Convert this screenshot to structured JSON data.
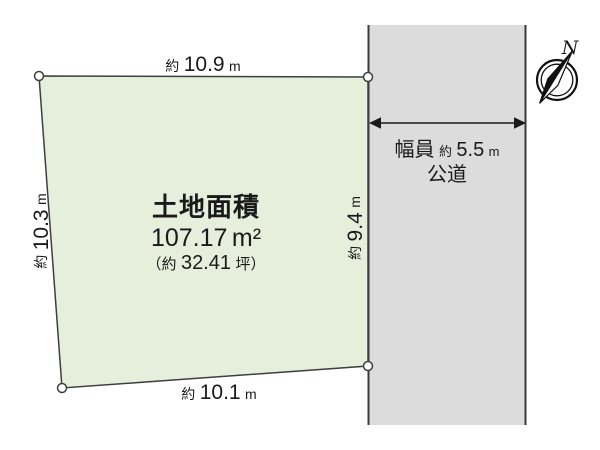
{
  "diagram": {
    "parcel": {
      "title": "土地面積",
      "area_value": "107.17",
      "area_unit": "m²",
      "tsubo_open": "（約",
      "tsubo_value": "32.41",
      "tsubo_close": "坪）"
    },
    "dimensions": {
      "top": {
        "prefix": "約",
        "value": "10.9",
        "unit": "m"
      },
      "left": {
        "prefix": "約",
        "value": "10.3",
        "unit": "m"
      },
      "right": {
        "prefix": "約",
        "value": "9.4",
        "unit": "m"
      },
      "bottom": {
        "prefix": "約",
        "value": "10.1",
        "unit": "m"
      }
    },
    "road": {
      "width_label": "幅員",
      "width_prefix": "約",
      "width_value": "5.5",
      "width_unit": "m",
      "name": "公道"
    },
    "compass": {
      "label": "N"
    },
    "colors": {
      "parcel_fill": "#e5efdb",
      "road_fill": "#dcdcdc",
      "line": "#3f3f3f"
    }
  }
}
